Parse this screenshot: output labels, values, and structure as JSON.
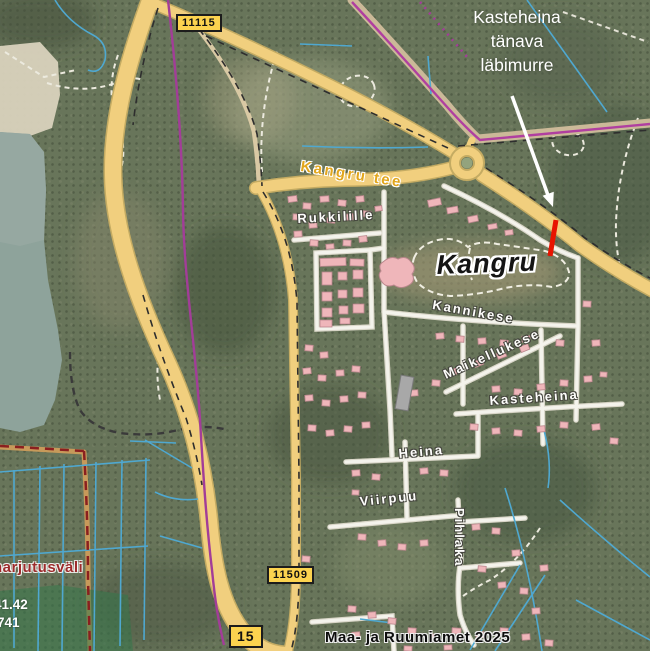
{
  "annotation": {
    "line1": "Kasteheina",
    "line2": "tänava",
    "line3": "läbimurre"
  },
  "road_numbers": {
    "r11115": "11115",
    "r11509": "11509",
    "r15": "15"
  },
  "road_names": {
    "kangru_tee": "Kangru tee"
  },
  "settlement": {
    "name": "Kangru"
  },
  "streets": {
    "rukkilille": "Rukkilille",
    "kannikese": "Kannikese",
    "maikellukese": "Maikellukese",
    "kasteheina": "Kasteheina",
    "heina": "Heina",
    "viirpuu": "Viirpuu",
    "pihlaka": "Pihlaka"
  },
  "area_labels": {
    "harjutusvali": "harjutusväli"
  },
  "parcel_numbers": {
    "n1": "41.42",
    "n2": "741"
  },
  "attribution": "Maa- ja Ruumiamet 2025",
  "colors": {
    "highlight_red": "#e81400",
    "road_fill": "#f1cf7e",
    "road_casing": "#c4ab62",
    "water": "#8ea39b",
    "building": "#efb6ba",
    "green_zone": "rgba(52,118,74,0.55)",
    "ditch_blue": "#4fa8d0",
    "utility_purple": "#a23d98",
    "boundary_darkred": "#8b1f1f"
  },
  "buildings": [
    [
      288,
      196,
      9,
      6,
      -8
    ],
    [
      303,
      203,
      8,
      6,
      4
    ],
    [
      320,
      196,
      9,
      6,
      -4
    ],
    [
      338,
      200,
      8,
      6,
      6
    ],
    [
      356,
      196,
      8,
      6,
      -6
    ],
    [
      293,
      214,
      8,
      6,
      3
    ],
    [
      309,
      222,
      8,
      6,
      -5
    ],
    [
      327,
      218,
      8,
      5,
      5
    ],
    [
      345,
      214,
      8,
      6,
      -4
    ],
    [
      363,
      211,
      8,
      6,
      5
    ],
    [
      375,
      206,
      7,
      5,
      -8
    ],
    [
      294,
      231,
      8,
      6,
      -3
    ],
    [
      310,
      240,
      8,
      6,
      4
    ],
    [
      326,
      244,
      8,
      5,
      -5
    ],
    [
      343,
      240,
      8,
      6,
      3
    ],
    [
      359,
      236,
      8,
      6,
      -6
    ],
    [
      320,
      258,
      26,
      8,
      -2
    ],
    [
      350,
      259,
      14,
      7,
      2
    ],
    [
      322,
      272,
      10,
      13,
      0
    ],
    [
      338,
      272,
      9,
      8,
      0
    ],
    [
      353,
      270,
      10,
      9,
      0
    ],
    [
      322,
      292,
      10,
      9,
      0
    ],
    [
      338,
      290,
      9,
      8,
      0
    ],
    [
      353,
      288,
      10,
      9,
      0
    ],
    [
      322,
      308,
      10,
      9,
      0
    ],
    [
      339,
      306,
      9,
      8,
      0
    ],
    [
      353,
      304,
      11,
      9,
      0
    ],
    [
      320,
      320,
      12,
      7,
      0
    ],
    [
      340,
      318,
      10,
      6,
      0
    ],
    [
      428,
      199,
      13,
      7,
      -12
    ],
    [
      447,
      207,
      11,
      6,
      -10
    ],
    [
      468,
      216,
      10,
      6,
      -12
    ],
    [
      488,
      224,
      9,
      5,
      -10
    ],
    [
      505,
      230,
      8,
      5,
      -8
    ],
    [
      305,
      345,
      8,
      6,
      5
    ],
    [
      320,
      352,
      8,
      6,
      -4
    ],
    [
      303,
      368,
      8,
      6,
      -6
    ],
    [
      318,
      375,
      8,
      6,
      3
    ],
    [
      336,
      370,
      8,
      6,
      -3
    ],
    [
      352,
      366,
      8,
      6,
      5
    ],
    [
      305,
      395,
      8,
      6,
      -5
    ],
    [
      322,
      400,
      8,
      6,
      4
    ],
    [
      340,
      396,
      8,
      6,
      -4
    ],
    [
      358,
      392,
      8,
      6,
      3
    ],
    [
      308,
      425,
      8,
      6,
      4
    ],
    [
      326,
      430,
      8,
      6,
      -5
    ],
    [
      344,
      426,
      8,
      6,
      5
    ],
    [
      362,
      422,
      8,
      6,
      -3
    ],
    [
      436,
      333,
      8,
      6,
      -5
    ],
    [
      456,
      336,
      8,
      6,
      4
    ],
    [
      478,
      338,
      8,
      6,
      -4
    ],
    [
      500,
      340,
      8,
      6,
      5
    ],
    [
      522,
      336,
      8,
      6,
      -5
    ],
    [
      556,
      340,
      8,
      6,
      4
    ],
    [
      452,
      368,
      9,
      6,
      -20
    ],
    [
      474,
      360,
      9,
      6,
      -22
    ],
    [
      497,
      352,
      9,
      6,
      -20
    ],
    [
      520,
      345,
      9,
      6,
      -22
    ],
    [
      432,
      380,
      8,
      6,
      5
    ],
    [
      410,
      390,
      8,
      6,
      -4
    ],
    [
      492,
      386,
      8,
      6,
      -4
    ],
    [
      514,
      389,
      8,
      6,
      4
    ],
    [
      537,
      384,
      8,
      6,
      -5
    ],
    [
      560,
      380,
      8,
      6,
      4
    ],
    [
      584,
      376,
      8,
      6,
      -4
    ],
    [
      470,
      424,
      8,
      6,
      4
    ],
    [
      492,
      428,
      8,
      6,
      -4
    ],
    [
      514,
      430,
      8,
      6,
      5
    ],
    [
      537,
      426,
      8,
      6,
      -5
    ],
    [
      560,
      422,
      8,
      6,
      4
    ],
    [
      592,
      424,
      8,
      6,
      -6
    ],
    [
      610,
      438,
      8,
      6,
      5
    ],
    [
      583,
      301,
      8,
      6,
      3
    ],
    [
      592,
      340,
      8,
      6,
      -4
    ],
    [
      600,
      372,
      7,
      5,
      4
    ],
    [
      352,
      470,
      8,
      6,
      -4
    ],
    [
      372,
      474,
      8,
      6,
      5
    ],
    [
      420,
      468,
      8,
      6,
      -5
    ],
    [
      440,
      470,
      8,
      6,
      4
    ],
    [
      352,
      490,
      7,
      5,
      3
    ],
    [
      358,
      534,
      8,
      6,
      4
    ],
    [
      378,
      540,
      8,
      6,
      -5
    ],
    [
      398,
      544,
      8,
      6,
      4
    ],
    [
      420,
      540,
      8,
      6,
      -4
    ],
    [
      302,
      556,
      8,
      6,
      5
    ],
    [
      472,
      524,
      8,
      6,
      -5
    ],
    [
      492,
      528,
      8,
      6,
      4
    ],
    [
      512,
      550,
      8,
      6,
      -4
    ],
    [
      478,
      566,
      8,
      6,
      5
    ],
    [
      498,
      582,
      8,
      6,
      -5
    ],
    [
      520,
      588,
      8,
      6,
      4
    ],
    [
      348,
      606,
      8,
      6,
      4
    ],
    [
      368,
      612,
      8,
      6,
      -4
    ],
    [
      388,
      618,
      8,
      6,
      5
    ],
    [
      352,
      632,
      8,
      6,
      -5
    ],
    [
      408,
      628,
      8,
      6,
      4
    ],
    [
      430,
      634,
      8,
      6,
      -4
    ],
    [
      452,
      628,
      9,
      6,
      4
    ],
    [
      476,
      632,
      8,
      6,
      -5
    ],
    [
      500,
      628,
      8,
      6,
      4
    ],
    [
      522,
      634,
      8,
      6,
      -4
    ],
    [
      404,
      646,
      8,
      5,
      3
    ],
    [
      444,
      645,
      8,
      5,
      -3
    ],
    [
      545,
      640,
      8,
      6,
      4
    ],
    [
      540,
      565,
      8,
      6,
      -5
    ],
    [
      532,
      608,
      8,
      6,
      -4
    ]
  ],
  "gray_building": [
    398,
    376,
    13,
    34,
    10
  ]
}
